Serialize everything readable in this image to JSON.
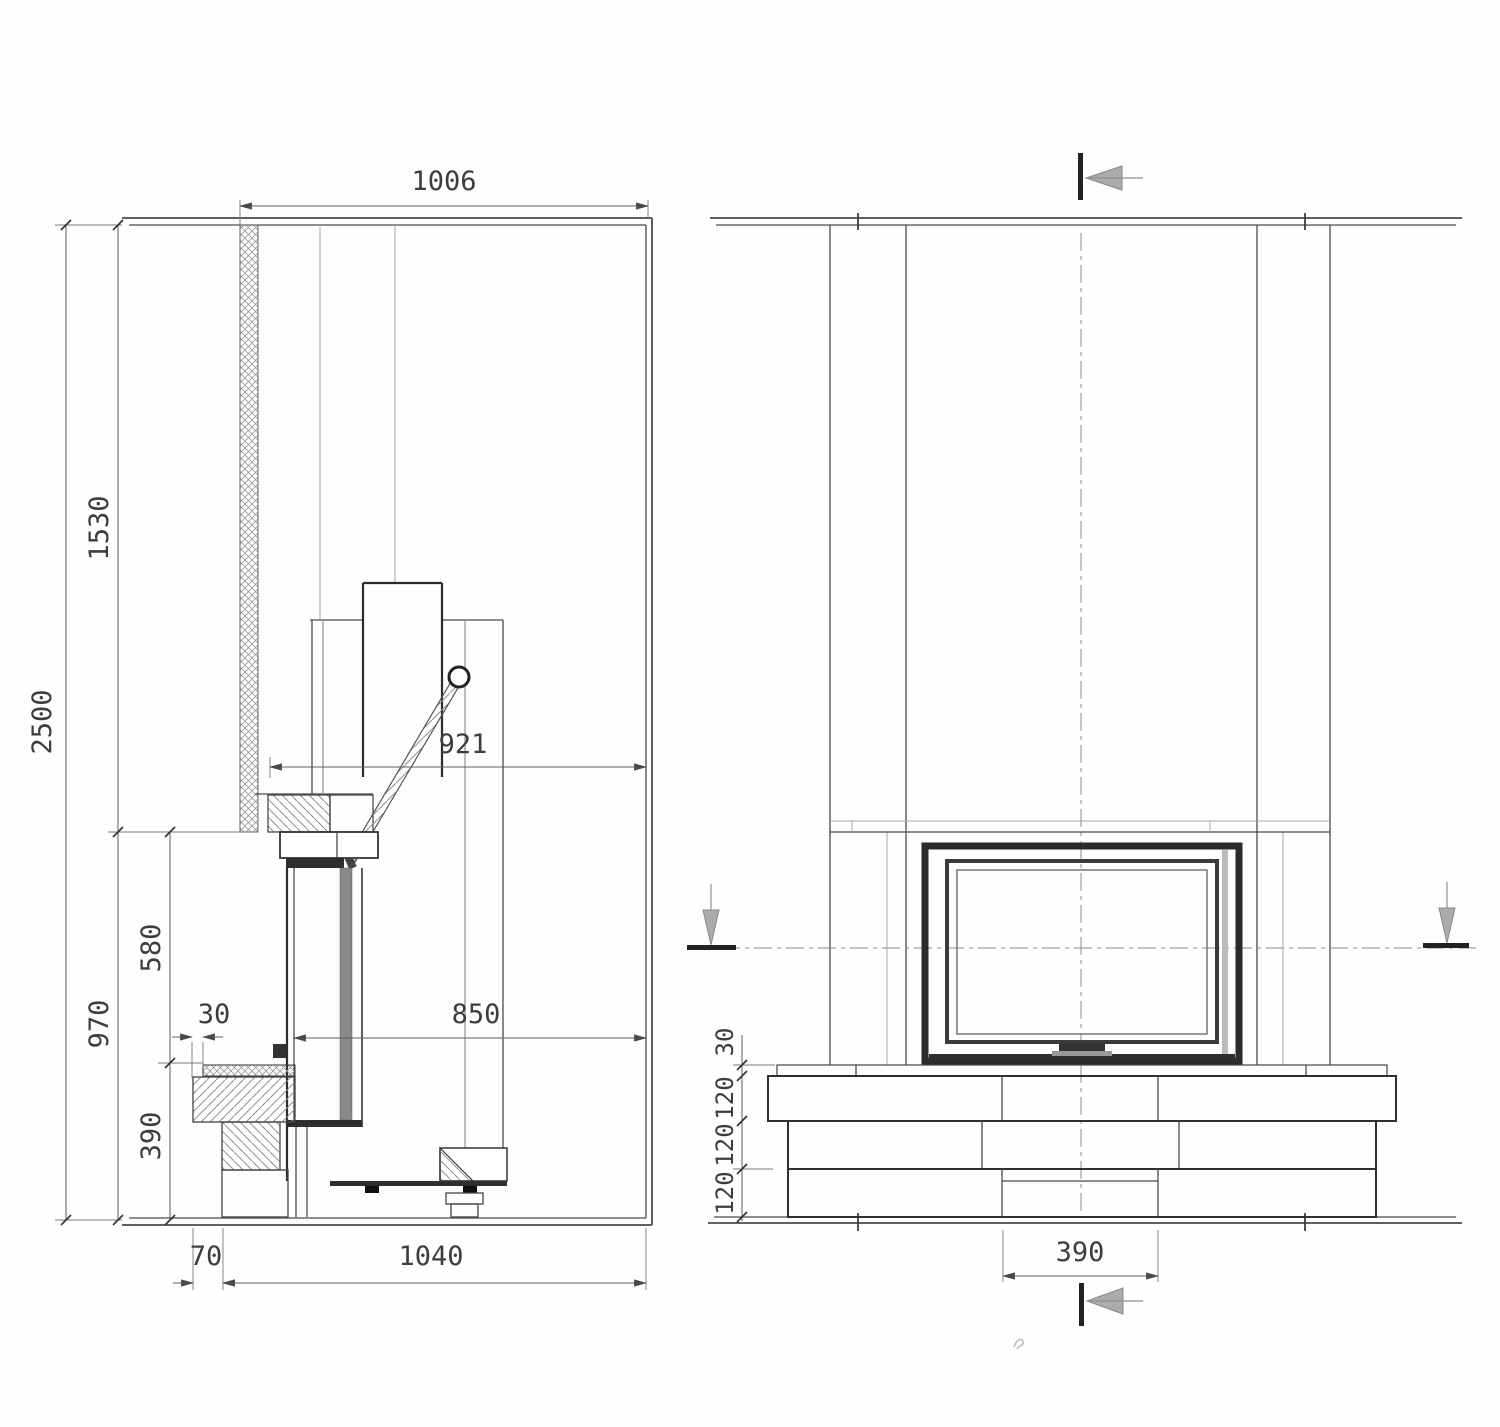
{
  "drawing": {
    "kind": "fireplace installation section and front elevation",
    "line_color": "#4a4a4a",
    "accent_dark": "#2c2c2c",
    "views": {
      "side_section": {
        "label": "side section view",
        "dims": {
          "top_width": "1006",
          "total_height": "2500",
          "upper_height": "1530",
          "lower_height": "970",
          "door_height": "580",
          "plinth_height": "390",
          "slab_setback": "30",
          "depth_upper": "921",
          "depth_glass": "850",
          "plinth_setback": "70",
          "plinth_depth": "1040"
        }
      },
      "front_elevation": {
        "label": "front elevation view",
        "dims": {
          "slab_thickness": "30",
          "course_1": "120",
          "course_2": "120",
          "course_3": "120",
          "base_width": "390"
        }
      }
    }
  }
}
